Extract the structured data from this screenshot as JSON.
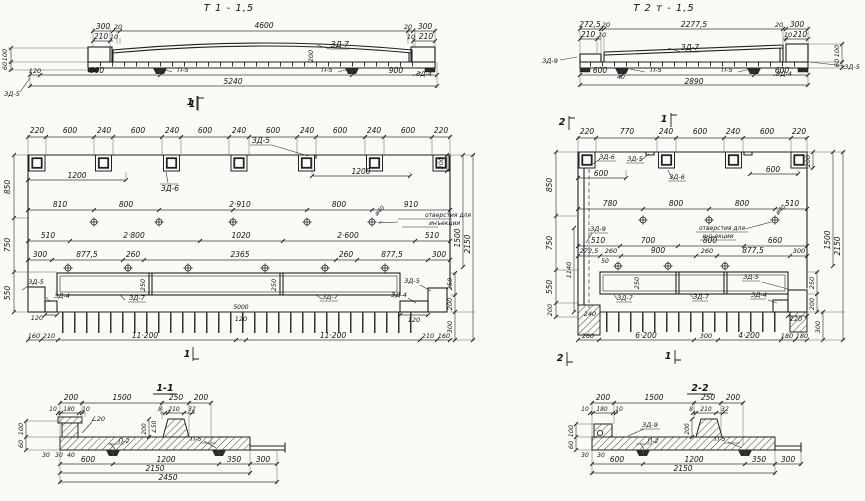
{
  "page": {
    "bg": "#fbfaf7",
    "ink": "#1f1f1f"
  },
  "t1_side": {
    "title": "Т 1 - 1,5",
    "top_dims": [
      "300",
      "20",
      "4600",
      "20",
      "300"
    ],
    "edge_dims": [
      "210",
      "10",
      "10",
      "210"
    ],
    "camber_dim": "200",
    "left_vert_dims": [
      "100",
      "60"
    ],
    "bottom_dims": [
      "120",
      "900",
      "900"
    ],
    "total": "5240",
    "labels": {
      "zd7": "ЗД-7",
      "p5_left": "П-5",
      "p5_right": "П-5",
      "zd4": "ЗД-4",
      "zd5": "ЗД-5"
    },
    "section_mark": "1"
  },
  "t2_side": {
    "title": "Т 2 т - 1,5",
    "top_dims": [
      "272,5",
      "20",
      "2277,5",
      "20",
      "300"
    ],
    "edge_dims": [
      "210",
      "10",
      "10",
      "210"
    ],
    "right_vert_dims": [
      "100",
      "60"
    ],
    "bottom_dims": [
      "600",
      "40",
      "600"
    ],
    "total": "2890",
    "labels": {
      "zd9": "ЗД-9",
      "zd7": "ЗД-7",
      "p5_left": "П-5",
      "p5_right": "П-5",
      "zd4": "ЗД-4",
      "zd5": "ЗД-5"
    }
  },
  "t1_front": {
    "top_chain": [
      "220",
      "600",
      "240",
      "600",
      "240",
      "600",
      "240",
      "600",
      "240",
      "600",
      "240",
      "600",
      "220"
    ],
    "dim_1200_a": "1200",
    "dim_1200_b": "1200",
    "row1": [
      "810",
      "800",
      "2·910",
      "800",
      "910"
    ],
    "row2": [
      "510",
      "2·800",
      "1020",
      "2·600",
      "510"
    ],
    "row3": [
      "300",
      "877,5",
      "260",
      "2365",
      "260",
      "877,5",
      "300"
    ],
    "bottom_chain": [
      "160",
      "210",
      "11·200",
      "11·200",
      "210",
      "160"
    ],
    "mid_small": [
      "5000",
      "120"
    ],
    "ledge_left": "120",
    "ledge_right": "120",
    "left_chain": [
      "850",
      "750",
      "550"
    ],
    "right_chain": [
      "200",
      "250",
      "200",
      "300",
      "1500",
      "2150"
    ],
    "rib_dims": [
      "250",
      "250"
    ],
    "labels": {
      "zd5_top": "ЗД-5",
      "zd6": "ЗД-6",
      "hole_note_1": "отверстия для",
      "hole_note_2": "инъекции",
      "hole_dia": "ø40",
      "zd7_a": "ЗД-7",
      "zd7_b": "ЗД-7",
      "zd5_left": "ЗД-5",
      "zd4_left": "ЗД-4",
      "zd5_right": "ЗД-5",
      "zd4_right": "ЗД-4"
    },
    "marks": {
      "top": "1",
      "bottom": "1"
    }
  },
  "t2_front": {
    "top_chain": [
      "220",
      "770",
      "240",
      "600",
      "240",
      "600",
      "220"
    ],
    "dim_600_left": "600",
    "dim_600_right": "600",
    "top_200": "200",
    "row1": [
      "780",
      "800",
      "800",
      "510"
    ],
    "row2": [
      "510",
      "700",
      "800",
      "660"
    ],
    "row3": [
      "272,5",
      "260",
      "900",
      "260",
      "877,5",
      "300"
    ],
    "row3_small": "50",
    "bottom_chain": [
      "260",
      "6·200",
      "300",
      "4·200",
      "180",
      "180"
    ],
    "support_dim": "240",
    "ledge_right": "120",
    "left_chain": [
      "850",
      "750",
      "550",
      "200"
    ],
    "inner_dim": "1140",
    "right_chain": [
      "250",
      "200",
      "300",
      "1500",
      "2150"
    ],
    "rib_dim": "250",
    "labels": {
      "zd6_a": "ЗД-6",
      "zd5_top": "ЗД-5",
      "zd6_b": "ЗД-6",
      "zd9": "ЗД-9",
      "hole_note_1": "отверстия для",
      "hole_note_2": "инъекции",
      "hole_dia": "ø40",
      "zd7_a": "ЗД-7",
      "zd7_b": "ЗД-7",
      "zd5_right": "ЗД-5",
      "zd4_right": "ЗД-4"
    },
    "marks": {
      "top_2": "2",
      "top_1": "1",
      "bottom_2": "2",
      "bottom_1": "1"
    }
  },
  "section_1_1": {
    "title": "1-1",
    "top_dims": [
      "200",
      "1500",
      "250",
      "200"
    ],
    "sub_left": [
      "10",
      "180",
      "10"
    ],
    "sub_right": [
      "8",
      "210",
      "32"
    ],
    "slope_left": "∠20",
    "slope_right": "∠50",
    "rib_height": "200",
    "left_vert": [
      "100",
      "60"
    ],
    "bottom_small": [
      "30",
      "30",
      "40"
    ],
    "bottom_dims": [
      "600",
      "1200",
      "350",
      "300"
    ],
    "totals": [
      "2150",
      "2450"
    ],
    "labels": {
      "p2": "П-2",
      "p5": "П-5"
    }
  },
  "section_2_2": {
    "title": "2-2",
    "top_dims": [
      "200",
      "1500",
      "250",
      "200"
    ],
    "sub_left": [
      "10",
      "180",
      "10"
    ],
    "sub_right": [
      "8",
      "210",
      "32"
    ],
    "rib_height": "200",
    "left_vert": [
      "100",
      "60"
    ],
    "bottom_small": [
      "30",
      "30"
    ],
    "bottom_dims": [
      "600",
      "1200",
      "350",
      "300"
    ],
    "total": "2150",
    "labels": {
      "zd9": "ЗД-9",
      "p2": "П-2",
      "p5": "П-5"
    }
  }
}
